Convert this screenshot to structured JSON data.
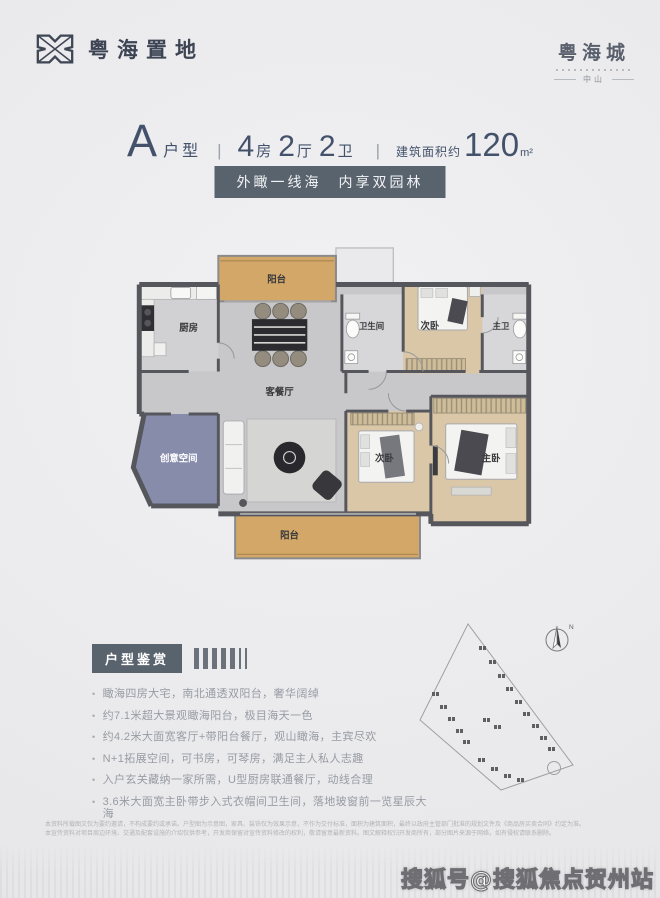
{
  "brand_left": {
    "name": "粤海置地"
  },
  "brand_right": {
    "name": "粤海城",
    "city": "中山"
  },
  "title": {
    "unit_letter": "A",
    "unit_word": "户型",
    "divider": "|",
    "spec": [
      {
        "n": "4",
        "u": "房"
      },
      {
        "n": "2",
        "u": "厅"
      },
      {
        "n": "2",
        "u": "卫"
      }
    ],
    "area_label": "建筑面积约",
    "area_number": "120",
    "area_unit": "m²"
  },
  "slogan": {
    "text": "外瞰一线海　内享双园林"
  },
  "floorplan": {
    "rooms": [
      {
        "label": "阳台"
      },
      {
        "label": "厨房"
      },
      {
        "label": "客餐厅"
      },
      {
        "label": "卫生间"
      },
      {
        "label": "次卧"
      },
      {
        "label": "主卫"
      },
      {
        "label": "创意空间"
      },
      {
        "label": "次卧"
      },
      {
        "label": "主卧"
      },
      {
        "label": "阳台"
      }
    ]
  },
  "features": {
    "heading": "户型鉴赏",
    "items": [
      "瞰海四房大宅，南北通透双阳台，奢华阔绰",
      "约7.1米超大景观瞰海阳台，极目海天一色",
      "约4.2米大面宽客厅+带阳台餐厅，观山瞰海，主宾尽欢",
      "N+1拓展空间，可书房，可琴房，满足主人私人志趣",
      "入户玄关藏纳一家所需，U型厨房联通餐厅，动线合理",
      "3.6米大面宽主卧带步入式衣帽间卫生间，落地玻窗前一览星辰大海"
    ]
  },
  "siteplan": {
    "north_label": "N"
  },
  "disclaimer": {
    "line1": "本资料所载图文仅为要约邀请，不构成要约或承诺。户型图为示意图，家具、装饰仅为效果示意，不作为交付标准，面积为建筑面积，最终以政府主管部门批准的规划文件及《商品房买卖合同》约定为准。",
    "line2": "本宣传资料对项目周边环境、交通及配套设施的介绍仅供参考，开发商保留对宣传资料修改的权利，敬请留意最新资料。图文解释权归开发商所有，部分图片来源于网络，如有侵权请联系删除。"
  },
  "watermark": {
    "text": "搜狐号@搜狐焦点贺州站"
  },
  "colors": {
    "accent": "#43526a",
    "badge_bg": "#59636e",
    "balcony": "#d2a768",
    "wood": "#dac7a7",
    "blue_room": "#878cab",
    "wall": "#56575c"
  }
}
